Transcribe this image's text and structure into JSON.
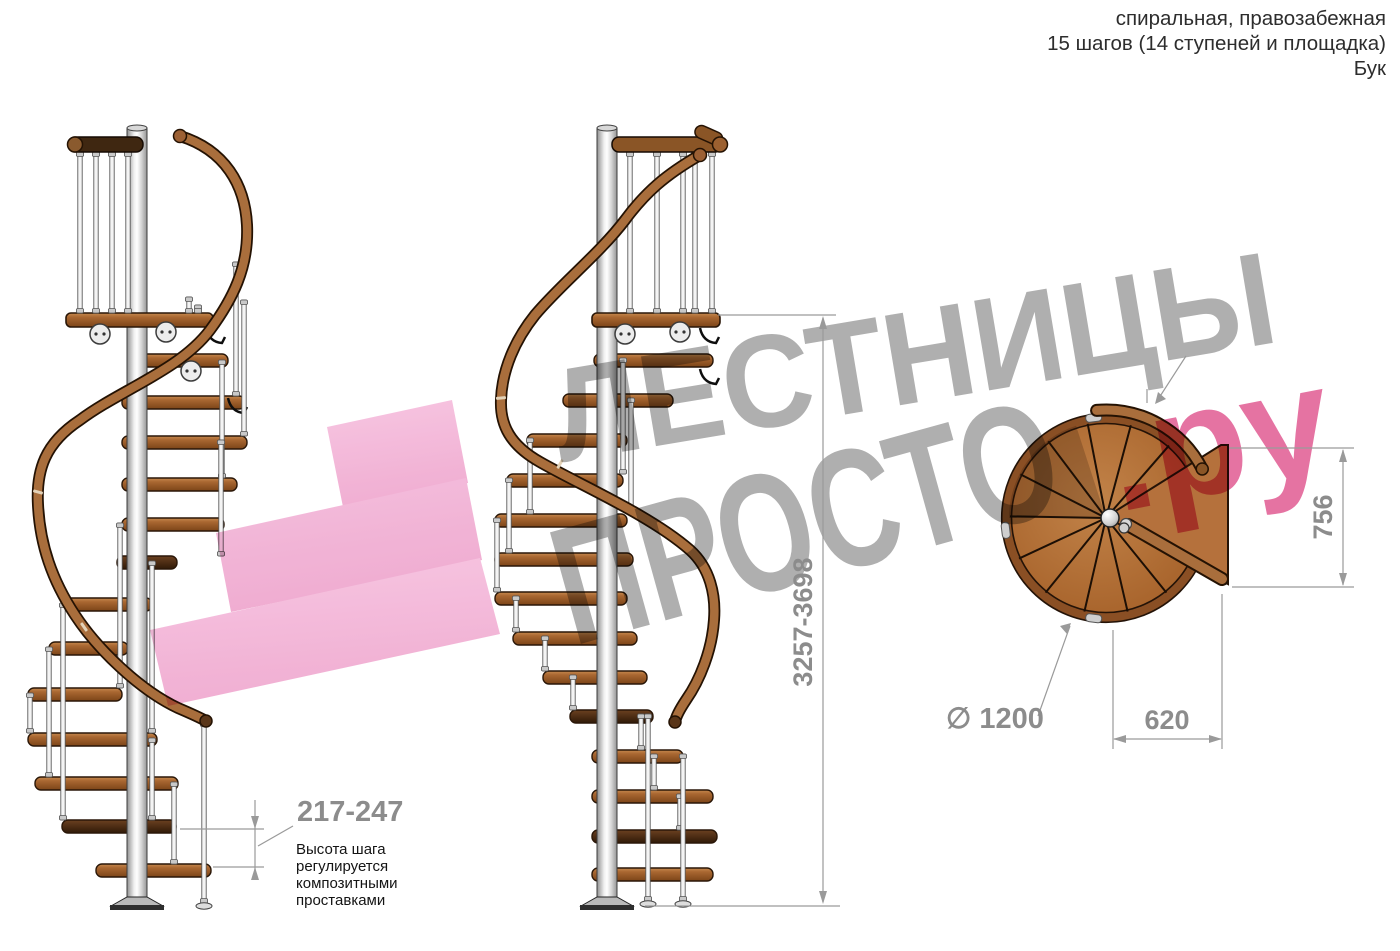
{
  "header": {
    "line1": "спиральная, правозабежная",
    "line2": "15 шагов (14 ступеней и площадка)",
    "line3": "Бук"
  },
  "watermark": {
    "word1": "ЛЕСТНИЦЫ",
    "word2": "ПРОСТО",
    "suffix": ".ру"
  },
  "dimensions": {
    "total_height": "3257-3698",
    "landing_depth": "756",
    "step_width": "620",
    "diameter": "∅ 1200",
    "step_height": "217-247"
  },
  "annotation": {
    "lines": [
      "Высота шага",
      "регулируется",
      "композитными",
      "проставками"
    ]
  },
  "colors": {
    "wood_step": "#9a5a28",
    "wood_step_dark": "#4a2b12",
    "wood_rail": "#a96e3c",
    "rail_outline": "#241203",
    "steel_light": "#f2f2f2",
    "watermark_gray": "#404040",
    "watermark_pink": "#dc3d7f",
    "arrow_pink": "#f3b0d5",
    "dim_line": "#9a9a9a",
    "dim_text": "#8c8c8c"
  },
  "figure": {
    "stairs": [
      {
        "name": "left-staircase",
        "pole_x": 137,
        "pole_top": 128,
        "pole_bottom": 906,
        "top_rail": {
          "x1": 68,
          "x2": 143,
          "y": 137,
          "dark": true,
          "cap": "left"
        },
        "rail_balusters": [
          80,
          96,
          112,
          128
        ],
        "rail_baluster_top": 152,
        "platform": {
          "x1": 66,
          "x2": 213,
          "y": 313
        },
        "plates": [
          [
            100,
            334
          ],
          [
            166,
            332
          ],
          [
            191,
            371
          ]
        ],
        "brackets": [
          [
            206,
            328
          ],
          [
            228,
            398
          ]
        ],
        "steps": [
          [
            354,
            128,
            228,
            0
          ],
          [
            396,
            122,
            245,
            0
          ],
          [
            436,
            122,
            247,
            0
          ],
          [
            478,
            122,
            237,
            0
          ],
          [
            518,
            122,
            224,
            0
          ],
          [
            556,
            117,
            177,
            1
          ],
          [
            598,
            64,
            152,
            0
          ],
          [
            642,
            49,
            128,
            0
          ],
          [
            688,
            28,
            122,
            0
          ],
          [
            733,
            28,
            157,
            0
          ],
          [
            777,
            35,
            178,
            0
          ],
          [
            820,
            62,
            176,
            1
          ],
          [
            864,
            96,
            211,
            0
          ]
        ],
        "balusters": [
          [
            236,
            262,
            396
          ],
          [
            244,
            300,
            436
          ],
          [
            222,
            360,
            478
          ],
          [
            221,
            440,
            556
          ],
          [
            120,
            523,
            688
          ],
          [
            152,
            561,
            733
          ],
          [
            63,
            603,
            820
          ],
          [
            49,
            647,
            777
          ],
          [
            30,
            693,
            733
          ],
          [
            174,
            782,
            864
          ],
          [
            204,
            722,
            903
          ],
          [
            152,
            738,
            820
          ],
          [
            189,
            297,
            313
          ],
          [
            198,
            305,
            313
          ]
        ],
        "feet": [
          [
            204,
            903
          ]
        ],
        "joints": [
          [
            38,
            492,
            -75
          ],
          [
            84,
            627,
            -35
          ]
        ],
        "handrail": "M 180,136 C 225,150 245,185 247,225 C 249,268 232,300 210,330 C 180,370 120,390 80,420 C 45,443 36,470 38,505 C 40,545 52,580 75,615 C 98,650 140,690 178,708 C 192,714 199,717 206,721",
        "rail_cap_start": [
          180,
          136
        ],
        "rail_cap_end": [
          206,
          721
        ]
      },
      {
        "name": "middle-staircase",
        "pole_x": 607,
        "pole_top": 128,
        "pole_bottom": 906,
        "top_rail": {
          "x1": 612,
          "x2": 722,
          "y": 137,
          "dark": false,
          "cap": "right"
        },
        "rail_balusters": [
          630,
          657,
          683,
          695,
          712
        ],
        "rail_baluster_top": 152,
        "platform": {
          "x1": 592,
          "x2": 720,
          "y": 313
        },
        "plates": [
          [
            625,
            334
          ],
          [
            680,
            332
          ]
        ],
        "brackets": [
          [
            700,
            328
          ],
          [
            700,
            369
          ]
        ],
        "steps": [
          [
            354,
            594,
            713,
            0
          ],
          [
            394,
            563,
            673,
            0
          ],
          [
            434,
            527,
            627,
            0
          ],
          [
            474,
            507,
            623,
            0
          ],
          [
            514,
            495,
            627,
            0
          ],
          [
            553,
            495,
            633,
            0
          ],
          [
            592,
            495,
            627,
            0
          ],
          [
            632,
            513,
            637,
            0
          ],
          [
            671,
            543,
            647,
            0
          ],
          [
            710,
            570,
            653,
            1
          ],
          [
            750,
            592,
            683,
            0
          ],
          [
            790,
            592,
            713,
            0
          ],
          [
            830,
            592,
            717,
            1
          ],
          [
            868,
            592,
            713,
            0
          ]
        ],
        "balusters": [
          [
            623,
            358,
            474
          ],
          [
            631,
            398,
            514
          ],
          [
            530,
            438,
            514
          ],
          [
            509,
            478,
            553
          ],
          [
            497,
            518,
            592
          ],
          [
            516,
            596,
            632
          ],
          [
            545,
            636,
            671
          ],
          [
            573,
            675,
            710
          ],
          [
            641,
            714,
            750
          ],
          [
            654,
            754,
            790
          ],
          [
            680,
            794,
            830
          ],
          [
            648,
            714,
            901
          ],
          [
            683,
            754,
            901
          ]
        ],
        "feet": [
          [
            648,
            901
          ],
          [
            683,
            901
          ]
        ],
        "joints": [
          [
            501,
            398,
            85
          ],
          [
            560,
            464,
            30
          ]
        ],
        "handrail": "M 700,155 C 665,175 645,193 625,220 C 600,253 560,285 535,315 C 515,340 502,370 501,400 C 500,425 510,445 540,462 C 580,485 650,515 690,550 C 710,568 716,595 714,620 C 712,650 700,680 686,700 C 680,709 676,716 675,722",
        "rail_cap_start": [
          700,
          155
        ],
        "rail_cap_end": [
          675,
          722
        ]
      }
    ],
    "plan": {
      "cx": 1106,
      "cy": 518,
      "r": 104,
      "hub": [
        1110,
        518
      ],
      "hub2": [
        1124,
        528
      ],
      "wedge": [
        [
          1106,
          517
        ],
        [
          1221,
          445
        ],
        [
          1228,
          445
        ],
        [
          1228,
          584
        ],
        [
          1128,
          529
        ]
      ],
      "radials": [
        49,
        75,
        101,
        127,
        153,
        179,
        205,
        231,
        257,
        283,
        309
      ],
      "shadow": [
        108,
        180
      ],
      "rail_arc": {
        "a1": 95,
        "a2": 27,
        "r": 108
      },
      "connectors": [
        97,
        187,
        263
      ],
      "rod": [
        [
          1128,
          525
        ],
        [
          1222,
          579
        ]
      ]
    },
    "arrow_bands": [
      [
        [
          327,
          427
        ],
        [
          452,
          400
        ],
        [
          468,
          483
        ],
        [
          343,
          507
        ]
      ],
      [
        [
          216,
          533
        ],
        [
          466,
          478
        ],
        [
          482,
          560
        ],
        [
          231,
          612
        ]
      ],
      [
        [
          150,
          630
        ],
        [
          480,
          558
        ],
        [
          500,
          634
        ],
        [
          168,
          706
        ]
      ]
    ]
  }
}
